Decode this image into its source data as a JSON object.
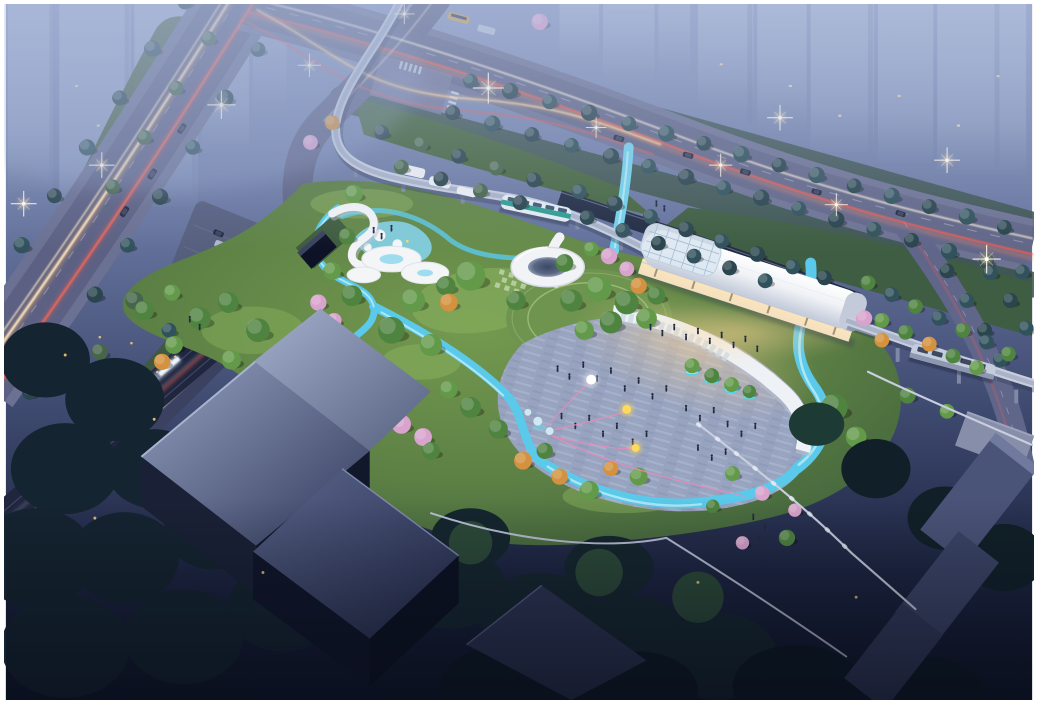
{
  "scene": {
    "type": "aerial-architectural-rendering",
    "time_of_day": "dusk",
    "description": "Bird's-eye dusk rendering of a transit-oriented pocket park: a white vaulted light-rail station with glass end bay, an elevated guideway with two trams, a sweeping white terrace deck with tree planters, a paved plaza with tiny pedestrians and glowing balloons on pink strings, winding cyan water-play ribbons, circular white pavilions, lawns with green, autumn and blossom trees, arterial roads with headlight and taillight trails, a rail line with a lit passenger train, hazy high-rise towers above, and dark office blocks below",
    "visible_text": []
  },
  "palette": {
    "sky": "#8a99c0",
    "tower": "#98a6c8",
    "road": "#6b7193",
    "ramp_road": "#3b4161",
    "trail_warm": "#ffe9c4",
    "trail_amber": "#ffb45e",
    "trail_red": "#ff5848",
    "park_green": "#5d8145",
    "lawn_light": "#86ad5c",
    "water": "#5bc9ea",
    "water_highlight": "#bdeef9",
    "plaza": "#97a3bf",
    "canopy_white": "#f2f4f7",
    "deck_white": "#eef1f5",
    "station_roof": "#f4f2ee",
    "station_glow": "#ffd9a0",
    "guideway": "#c6cedf",
    "tram_teal": "#2e9e90",
    "building_dark": "#2c3452",
    "building_lit_edge": "#a9b4d0",
    "train_light": "#eef4fc",
    "balloon_yellow": "#ffd95e",
    "balloon_white": "#ffffff",
    "string_pink": "#f08ab8",
    "wall_light": "#c8cede",
    "flare": "#fff8e8"
  },
  "elements": {
    "station": "white barrel-vault light-rail station with glass grid end",
    "guideway": "elevated curved tram guideway on pillars",
    "tram_center": "teal-striped tram on curve",
    "tram_east": "grey tram leaving station eastward",
    "plaza": "paved event plaza with pedestrians",
    "terrace_deck": "curved white terrace with glowing tree planters",
    "oculus_pavilion": "round white canopy with dark oculus",
    "disc_pavilion": "cluster of white disc roofs with aqua pools",
    "playground": "aqua playground patch with mini canopies",
    "water_ribbon": "winding cyan water-play ribbon",
    "balloons": "glowing balloons on pink strings",
    "train": "lit passenger train on rail corridor",
    "towers": "hazy residential high-rises",
    "office_blocks": "dark flat-roof blocks in shadow",
    "roads": "arterials with light trails and street lamps"
  }
}
